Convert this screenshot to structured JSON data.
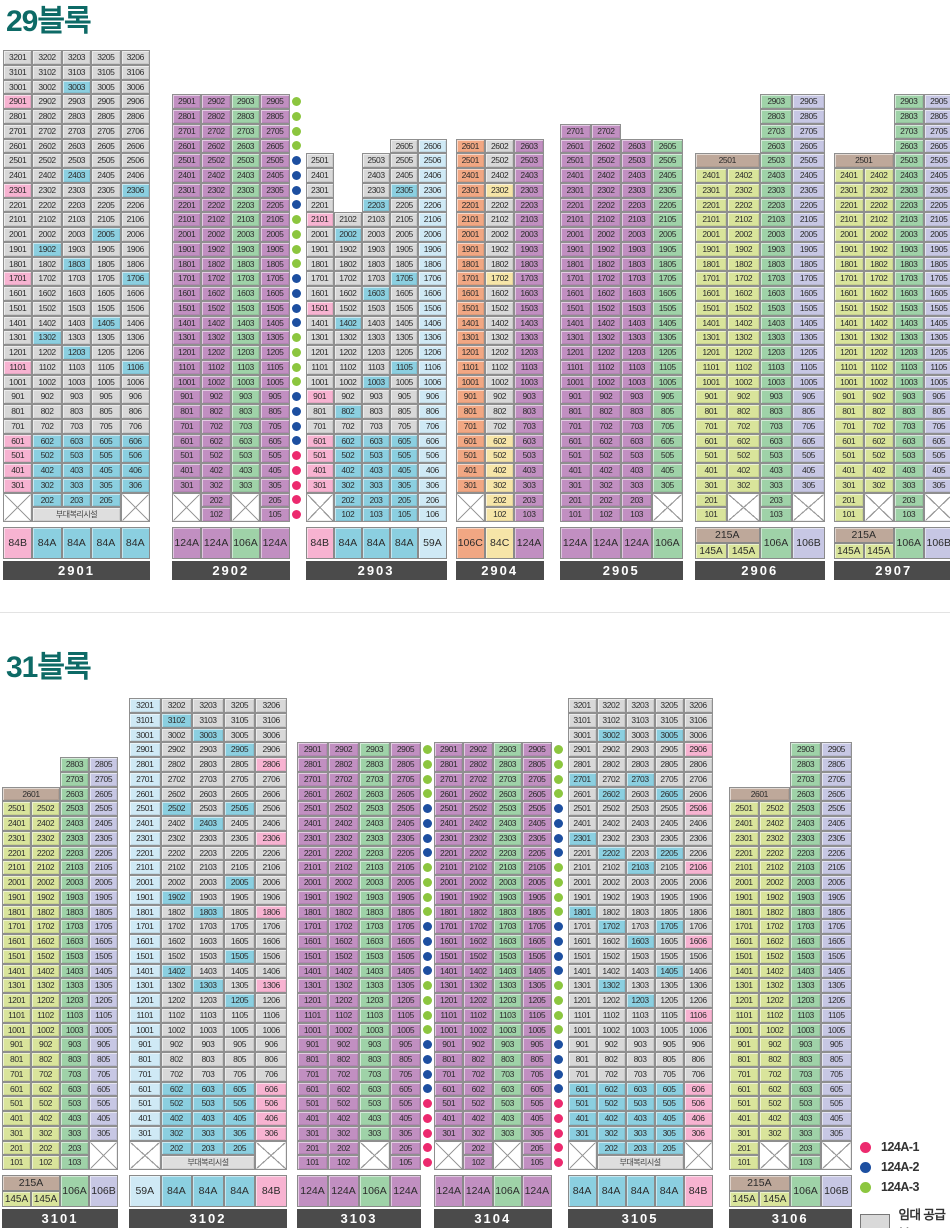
{
  "titles": {
    "block29": "29블록",
    "block31": "31블록"
  },
  "labels": {
    "welfare": "부대복리시설",
    "rental": "임대 공급분"
  },
  "type_colors": {
    "84A": "#8bcfe0",
    "84B": "#f7b3d1",
    "84C": "#f6e5a8",
    "59A": "#cfe9f5",
    "124A": "#c18fc1",
    "106A": "#9fd2a8",
    "106B": "#c7c7e4",
    "106C": "#f1a783",
    "215A": "#bea89a",
    "145A": "#d9e49b",
    "rental": "#d8d8d8"
  },
  "dot_colors": {
    "p": "#ec2a6e",
    "b": "#1d4fa0",
    "g": "#8cc63f"
  },
  "legend": {
    "variants": [
      {
        "label": "124A-1",
        "dot": "p"
      },
      {
        "label": "124A-2",
        "dot": "b"
      },
      {
        "label": "124A-3",
        "dot": "g"
      }
    ],
    "rental_label": "임대 공급분"
  },
  "blocks": [
    {
      "key": "b29",
      "title": "29블록",
      "buildings": [
        {
          "id": "2901",
          "ml": 0,
          "cw": 29.4,
          "welfare": true,
          "cols": [
            {
              "sfx": "01",
              "type": "84B",
              "mode": "rental",
              "top": 32,
              "bottom": 3,
              "band": [
                6,
                3
              ],
              "x2": true
            },
            {
              "sfx": "02",
              "type": "84A",
              "mode": "rental",
              "top": 32,
              "bottom": 2,
              "band": [
                6,
                2
              ]
            },
            {
              "sfx": "03",
              "type": "84A",
              "mode": "rental",
              "top": 32,
              "bottom": 2,
              "band": [
                6,
                2
              ]
            },
            {
              "sfx": "05",
              "type": "84A",
              "mode": "rental",
              "top": 32,
              "bottom": 2,
              "band": [
                6,
                2
              ]
            },
            {
              "sfx": "06",
              "type": "84A",
              "mode": "rental",
              "top": 32,
              "bottom": 3,
              "band": [
                6,
                3
              ],
              "x2": true
            }
          ],
          "hl": [
            2901,
            2301,
            1701,
            1101,
            3003,
            2403,
            2306,
            2005,
            1902,
            1803,
            1706,
            1405,
            1302,
            1203,
            1106
          ],
          "footer": [
            "84B",
            "84A",
            "84A",
            "84A",
            "84A"
          ]
        },
        {
          "id": "2902",
          "ml": 22,
          "cw": 29.4,
          "cols": [
            {
              "sfx": "01",
              "type": "124A",
              "mode": "full",
              "top": 29,
              "bottom": 3,
              "x2": true
            },
            {
              "sfx": "02",
              "type": "124A",
              "mode": "full",
              "top": 29,
              "bottom": 1
            },
            {
              "sfx": "03",
              "type": "106A",
              "mode": "full",
              "top": 29,
              "bottom": 3,
              "x2": true
            },
            {
              "sfx": "05",
              "type": "124A",
              "mode": "full",
              "top": 29,
              "bottom": 1
            }
          ],
          "dots": "ggggbbbbggggbbbbggggbbbbppppp",
          "footer": [
            "124A",
            "124A",
            "106A",
            "124A"
          ]
        },
        {
          "id": "2903",
          "ml": 3,
          "cw": 28.2,
          "cols": [
            {
              "sfx": "01",
              "type": "84B",
              "mode": "rental",
              "top": 25,
              "bottom": 3,
              "band": [
                6,
                3
              ],
              "x2": true
            },
            {
              "sfx": "02",
              "type": "84A",
              "mode": "rental",
              "top": 21,
              "bottom": 1,
              "band": [
                6,
                1
              ]
            },
            {
              "sfx": "03",
              "type": "84A",
              "mode": "rental",
              "top": 25,
              "bottom": 1,
              "band": [
                6,
                1
              ]
            },
            {
              "sfx": "05",
              "type": "84A",
              "mode": "rental",
              "top": 26,
              "bottom": 1,
              "band": [
                6,
                1
              ]
            },
            {
              "sfx": "06",
              "type": "59A",
              "mode": "full",
              "top": 26,
              "bottom": 1
            }
          ],
          "hl": [
            2101,
            1501,
            901,
            2305,
            2203,
            2002,
            1705,
            1603,
            1402,
            1105,
            1003,
            802
          ],
          "footer": [
            "84B",
            "84A",
            "84A",
            "84A",
            "59A"
          ]
        },
        {
          "id": "2904",
          "ml": 9,
          "cw": 29.4,
          "cols": [
            {
              "sfx": "01",
              "type": "106C",
              "mode": "full",
              "top": 26,
              "bottom": 3,
              "x2": true
            },
            {
              "sfx": "02",
              "type": "84C",
              "mode": "rental",
              "top": 26,
              "bottom": 1,
              "band": [
                6,
                1
              ]
            },
            {
              "sfx": "03",
              "type": "124A",
              "mode": "full",
              "top": 26,
              "bottom": 1
            }
          ],
          "hl": [
            2302,
            1702
          ],
          "footer": [
            "106C",
            "84C",
            "124A"
          ]
        },
        {
          "id": "2905",
          "ml": 16,
          "cw": 30.75,
          "cols": [
            {
              "sfx": "01",
              "type": "124A",
              "mode": "full",
              "top": 27,
              "bottom": 1
            },
            {
              "sfx": "02",
              "type": "124A",
              "mode": "full",
              "top": 27,
              "bottom": 1
            },
            {
              "sfx": "03",
              "type": "124A",
              "mode": "full",
              "top": 26,
              "bottom": 1
            },
            {
              "sfx": "05",
              "type": "106A",
              "mode": "full",
              "top": 26,
              "bottom": 3,
              "x2": true
            }
          ],
          "footer": [
            "124A",
            "124A",
            "124A",
            "106A"
          ]
        },
        {
          "id": "2906",
          "ml": 12,
          "cw": 32.5,
          "cols": [
            {
              "sfx": "01",
              "type": "145A",
              "mode": "full",
              "top": 24,
              "bottom": 1
            },
            {
              "sfx": "02",
              "type": "145A",
              "mode": "full",
              "top": 24,
              "bottom": 3,
              "x2": true
            },
            {
              "sfx": "03",
              "type": "106A",
              "mode": "full",
              "top": 29,
              "bottom": 1
            },
            {
              "sfx": "05",
              "type": "106B",
              "mode": "full",
              "top": 29,
              "bottom": 3,
              "x2": true
            }
          ],
          "merge_top": {
            "label": "2501",
            "floor": 25,
            "col": 0,
            "span": 2,
            "type": "215A"
          },
          "footer_stacked": {
            "top": "215A",
            "bottom": [
              "145A",
              "145A"
            ],
            "rest": [
              "106A",
              "106B"
            ]
          }
        },
        {
          "id": "2907",
          "ml": 9,
          "cw": 30,
          "cols": [
            {
              "sfx": "01",
              "type": "145A",
              "mode": "full",
              "top": 24,
              "bottom": 1
            },
            {
              "sfx": "02",
              "type": "145A",
              "mode": "full",
              "top": 24,
              "bottom": 3,
              "x2": true
            },
            {
              "sfx": "03",
              "type": "106A",
              "mode": "full",
              "top": 29,
              "bottom": 1
            },
            {
              "sfx": "05",
              "type": "106B",
              "mode": "full",
              "top": 29,
              "bottom": 3,
              "x2": true
            }
          ],
          "merge_top": {
            "label": "2501",
            "floor": 25,
            "col": 0,
            "span": 2,
            "type": "215A"
          },
          "footer_stacked": {
            "top": "215A",
            "bottom": [
              "145A",
              "145A"
            ],
            "rest": [
              "106A",
              "106B"
            ]
          }
        }
      ]
    },
    {
      "key": "b31",
      "title": "31블록",
      "buildings": [
        {
          "id": "3101",
          "ml": 0,
          "cw": 29,
          "cols": [
            {
              "sfx": "01",
              "type": "145A",
              "mode": "full",
              "top": 25,
              "bottom": 1
            },
            {
              "sfx": "02",
              "type": "145A",
              "mode": "full",
              "top": 25,
              "bottom": 1
            },
            {
              "sfx": "03",
              "type": "106A",
              "mode": "full",
              "top": 28,
              "bottom": 1
            },
            {
              "sfx": "05",
              "type": "106B",
              "mode": "full",
              "top": 28,
              "bottom": 3,
              "x2": true
            }
          ],
          "merge_top": {
            "label": "2601",
            "floor": 26,
            "col": 0,
            "span": 2,
            "type": "215A"
          },
          "footer_stacked": {
            "top": "215A",
            "bottom": [
              "145A",
              "145A"
            ],
            "rest": [
              "106A",
              "106B"
            ]
          }
        },
        {
          "id": "3102",
          "ml": 11,
          "cw": 31.6,
          "welfare": true,
          "cols": [
            {
              "sfx": "01",
              "type": "59A",
              "mode": "full",
              "top": 32,
              "bottom": 3,
              "x2": true
            },
            {
              "sfx": "02",
              "type": "84A",
              "mode": "rental",
              "top": 32,
              "bottom": 2,
              "band": [
                6,
                2
              ]
            },
            {
              "sfx": "03",
              "type": "84A",
              "mode": "rental",
              "top": 32,
              "bottom": 2,
              "band": [
                6,
                2
              ]
            },
            {
              "sfx": "05",
              "type": "84A",
              "mode": "rental",
              "top": 32,
              "bottom": 2,
              "band": [
                6,
                2
              ]
            },
            {
              "sfx": "06",
              "type": "84B",
              "mode": "rental",
              "top": 32,
              "bottom": 3,
              "band": [
                6,
                3
              ],
              "x2": true
            }
          ],
          "hl": [
            3102,
            3003,
            2905,
            2505,
            2502,
            2403,
            2005,
            1902,
            1803,
            1505,
            1402,
            1303,
            1205,
            2806,
            2306,
            1806,
            1306
          ],
          "footer": [
            "59A",
            "84A",
            "84A",
            "84A",
            "84B"
          ]
        },
        {
          "id": "3103",
          "ml": 10,
          "cw": 31,
          "cols": [
            {
              "sfx": "01",
              "type": "124A",
              "mode": "full",
              "top": 29,
              "bottom": 1
            },
            {
              "sfx": "02",
              "type": "124A",
              "mode": "full",
              "top": 29,
              "bottom": 1
            },
            {
              "sfx": "03",
              "type": "106A",
              "mode": "full",
              "top": 29,
              "bottom": 3,
              "x2": true
            },
            {
              "sfx": "05",
              "type": "124A",
              "mode": "full",
              "top": 29,
              "bottom": 1
            }
          ],
          "dots": "ggggbbbbggggbbbbggggbbbbppppp",
          "footer": [
            "124A",
            "124A",
            "106A",
            "124A"
          ]
        },
        {
          "id": "3104",
          "ml": 0,
          "cw": 29.4,
          "cols": [
            {
              "sfx": "01",
              "type": "124A",
              "mode": "full",
              "top": 29,
              "bottom": 3,
              "x2": true
            },
            {
              "sfx": "02",
              "type": "124A",
              "mode": "full",
              "top": 29,
              "bottom": 1
            },
            {
              "sfx": "03",
              "type": "106A",
              "mode": "full",
              "top": 29,
              "bottom": 3,
              "x2": true
            },
            {
              "sfx": "05",
              "type": "124A",
              "mode": "full",
              "top": 29,
              "bottom": 1
            }
          ],
          "dots": "ggggbbbbggggbbbbggggbbbbppppp",
          "footer": [
            "124A",
            "124A",
            "106A",
            "124A"
          ]
        },
        {
          "id": "3105",
          "ml": 3,
          "cw": 29,
          "welfare": true,
          "cols": [
            {
              "sfx": "01",
              "type": "84A",
              "mode": "rental",
              "top": 32,
              "bottom": 3,
              "band": [
                6,
                3
              ],
              "x2": true
            },
            {
              "sfx": "02",
              "type": "84A",
              "mode": "rental",
              "top": 32,
              "bottom": 2,
              "band": [
                6,
                2
              ]
            },
            {
              "sfx": "03",
              "type": "84A",
              "mode": "rental",
              "top": 32,
              "bottom": 2,
              "band": [
                6,
                2
              ]
            },
            {
              "sfx": "05",
              "type": "84A",
              "mode": "rental",
              "top": 32,
              "bottom": 2,
              "band": [
                6,
                2
              ]
            },
            {
              "sfx": "06",
              "type": "84B",
              "mode": "rental",
              "top": 32,
              "bottom": 3,
              "band": [
                6,
                3
              ],
              "x2": true
            }
          ],
          "hl": [
            3002,
            3005,
            2701,
            2703,
            2602,
            2605,
            2301,
            2202,
            2205,
            2103,
            1801,
            1702,
            1705,
            1603,
            1405,
            1302,
            1203,
            2906,
            2506,
            2106,
            1606,
            1106
          ],
          "footer": [
            "84A",
            "84A",
            "84A",
            "84A",
            "84B"
          ]
        },
        {
          "id": "3106",
          "ml": 16,
          "cw": 30.8,
          "cols": [
            {
              "sfx": "01",
              "type": "145A",
              "mode": "full",
              "top": 25,
              "bottom": 1
            },
            {
              "sfx": "02",
              "type": "145A",
              "mode": "full",
              "top": 25,
              "bottom": 3,
              "x2": true
            },
            {
              "sfx": "03",
              "type": "106A",
              "mode": "full",
              "top": 29,
              "bottom": 1
            },
            {
              "sfx": "05",
              "type": "106B",
              "mode": "full",
              "top": 29,
              "bottom": 3,
              "x2": true
            }
          ],
          "merge_top": {
            "label": "2601",
            "floor": 26,
            "col": 0,
            "span": 2,
            "type": "215A"
          },
          "footer_stacked": {
            "top": "215A",
            "bottom": [
              "145A",
              "145A"
            ],
            "rest": [
              "106A",
              "106B"
            ]
          }
        }
      ]
    }
  ],
  "layout": {
    "row_h": 14.75
  }
}
